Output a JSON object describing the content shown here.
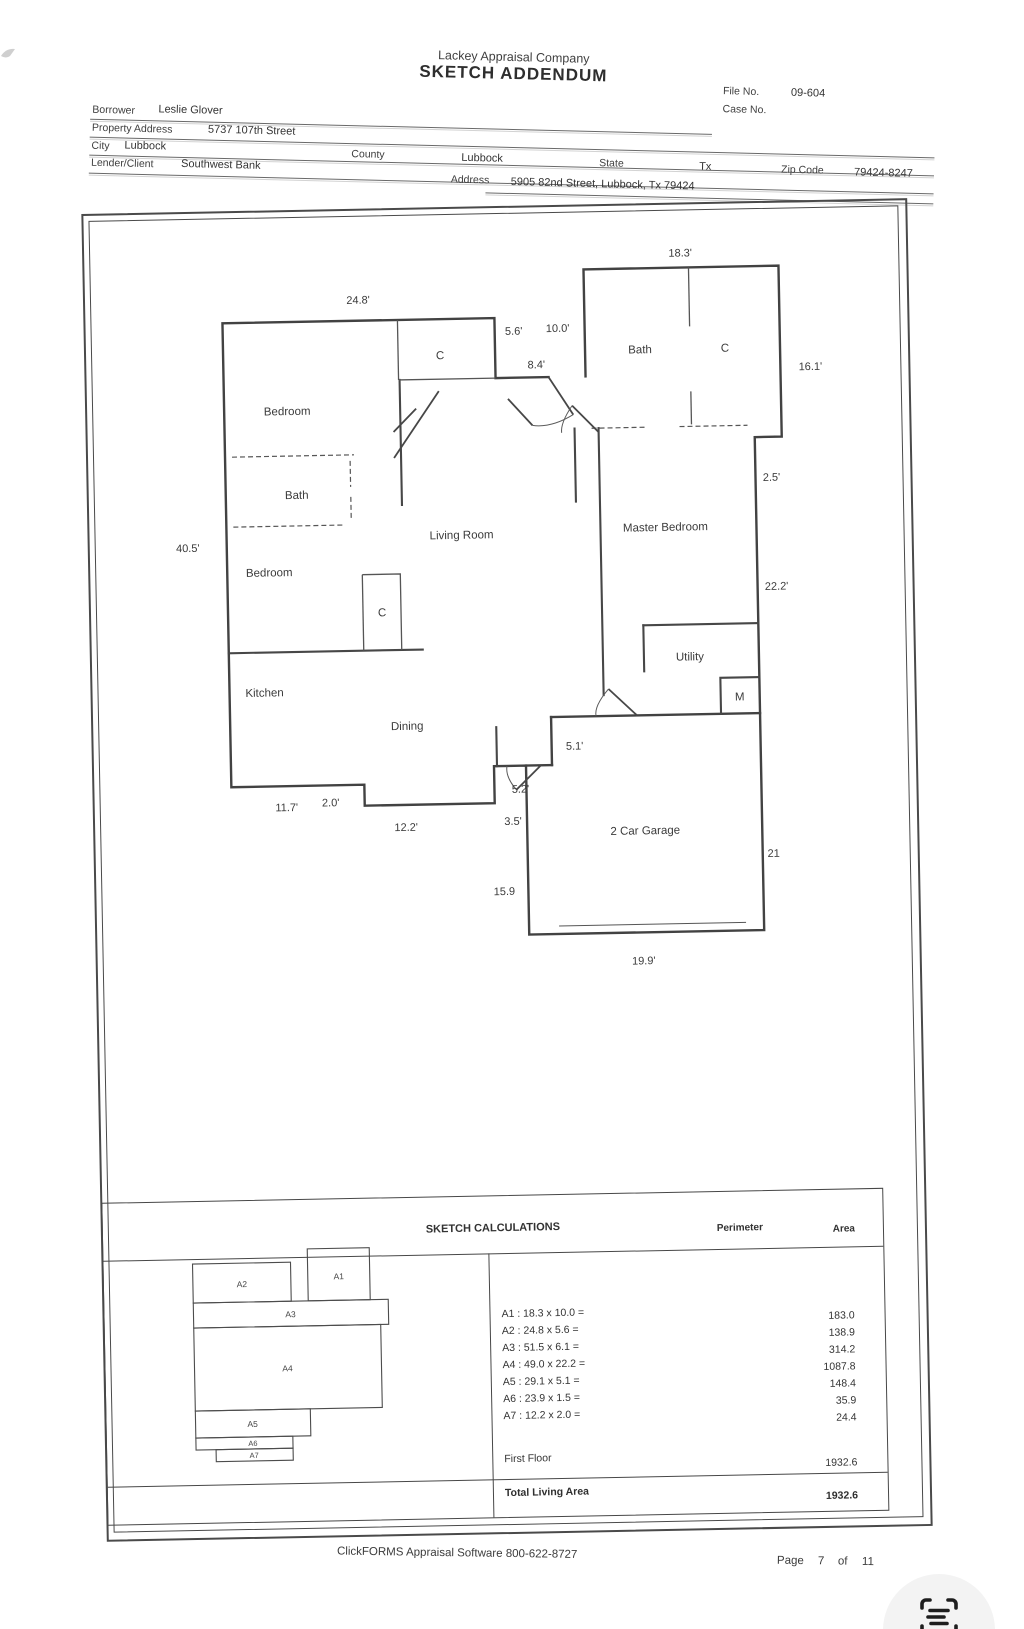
{
  "header": {
    "company": "Lackey Appraisal Company",
    "title": "SKETCH ADDENDUM",
    "file_no_label": "File No.",
    "file_no": "09-604",
    "case_no_label": "Case No."
  },
  "form": {
    "borrower_label": "Borrower",
    "borrower": "Leslie Glover",
    "property_address_label": "Property Address",
    "property_address": "5737 107th Street",
    "city_label": "City",
    "city": "Lubbock",
    "county_label": "County",
    "county": "Lubbock",
    "state_label": "State",
    "state": "Tx",
    "zip_label": "Zip Code",
    "zip": "79424-8247",
    "lender_label": "Lender/Client",
    "lender": "Southwest Bank",
    "address_label": "Address",
    "address": "5905 82nd Street, Lubbock, Tx 79424"
  },
  "floor_plan": {
    "room_labels": [
      "Bedroom",
      "Bath",
      "Bedroom",
      "Kitchen",
      "Dining",
      "Living Room",
      "Master Bedroom",
      "Utility",
      "2 Car Garage",
      "Bath",
      "C",
      "C",
      "C",
      "M"
    ],
    "dim_labels": [
      "18.3'",
      "24.8'",
      "5.6'",
      "10.0'",
      "8.4'",
      "16.1'",
      "2.5'",
      "40.5'",
      "22.2'",
      "5.1'",
      "2.0'",
      "11.7'",
      "5.2'",
      "3.5'",
      "12.2'",
      "15.9",
      "21",
      "19.9'"
    ]
  },
  "calculations": {
    "title": "SKETCH CALCULATIONS",
    "perimeter_header": "Perimeter",
    "area_header": "Area",
    "mini_labels": [
      "A1",
      "A2",
      "A3",
      "A4",
      "A5",
      "A6",
      "A7"
    ],
    "rows": [
      {
        "formula": "A1 : 18.3 x 10.0 =",
        "area": "183.0"
      },
      {
        "formula": "A2 : 24.8 x 5.6 =",
        "area": "138.9"
      },
      {
        "formula": "A3 : 51.5 x 6.1 =",
        "area": "314.2"
      },
      {
        "formula": "A4 : 49.0 x 22.2 =",
        "area": "1087.8"
      },
      {
        "formula": "A5 : 29.1 x 5.1 =",
        "area": "148.4"
      },
      {
        "formula": "A6 : 23.9 x 1.5 =",
        "area": "35.9"
      },
      {
        "formula": "A7 : 12.2 x 2.0 =",
        "area": "24.4"
      }
    ],
    "first_floor_label": "First Floor",
    "first_floor_area": "1932.6",
    "total_label": "Total Living Area",
    "total_area": "1932.6"
  },
  "footer": {
    "software_line": "ClickFORMS Appraisal Software 800-622-8727",
    "page_label": "Page",
    "page_number": "7",
    "of_label": "of",
    "page_total": "11"
  }
}
